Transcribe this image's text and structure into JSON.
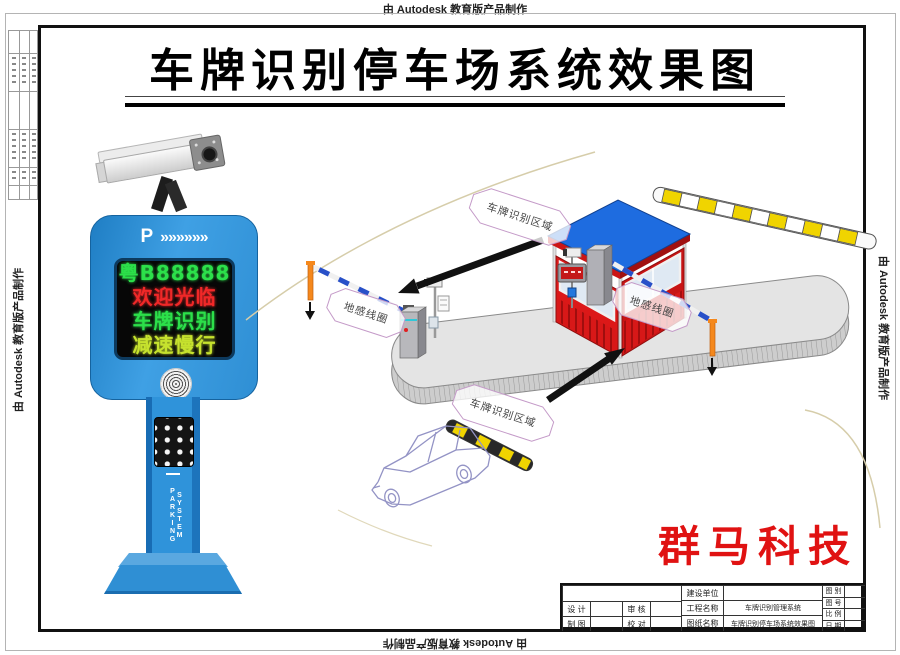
{
  "page": {
    "stamp": "由 Autodesk 教育版产品制作",
    "title": "车牌识别停车场系统效果图",
    "brand_text": "群马科技",
    "colors": {
      "brand_red": "#e01212",
      "kiosk_blue": "#2f93da",
      "booth_red": "#dd1a1a",
      "roof_blue": "#1e6ce0",
      "led_green": "#2ce04a",
      "led_red": "#f02828",
      "led_yellow": "#c6e22e",
      "bump_yellow": "#f0d400"
    }
  },
  "kiosk": {
    "p_label": "P",
    "chevrons": "»»»»»»",
    "led_lines": [
      {
        "text": "粤B88888",
        "color": "#2ce04a"
      },
      {
        "text": "欢迎光临",
        "color": "#f02828"
      },
      {
        "text": "车牌识别",
        "color": "#2ce04a"
      },
      {
        "text": "减速慢行",
        "color": "#c6e22e"
      }
    ],
    "pillar_label": "PARKING SYSTEM"
  },
  "scene": {
    "labels": {
      "plate_top": "车牌识别区域",
      "coil_left": "地感线圈",
      "coil_right": "地感线圈",
      "plate_bottom": "车牌识别区域"
    }
  },
  "title_block": {
    "design": "设 计",
    "draft": "制 图",
    "review": "审 核",
    "proof": "校 对",
    "owner": "建设单位",
    "project": "工程名称",
    "project_value": "车牌识别管理系统",
    "drawing": "图纸名称",
    "drawing_value": "车牌识别停车场系统效果图",
    "fig_type": "图 别",
    "fig_no": "图 号",
    "scale": "比 例",
    "date": "日 期"
  }
}
